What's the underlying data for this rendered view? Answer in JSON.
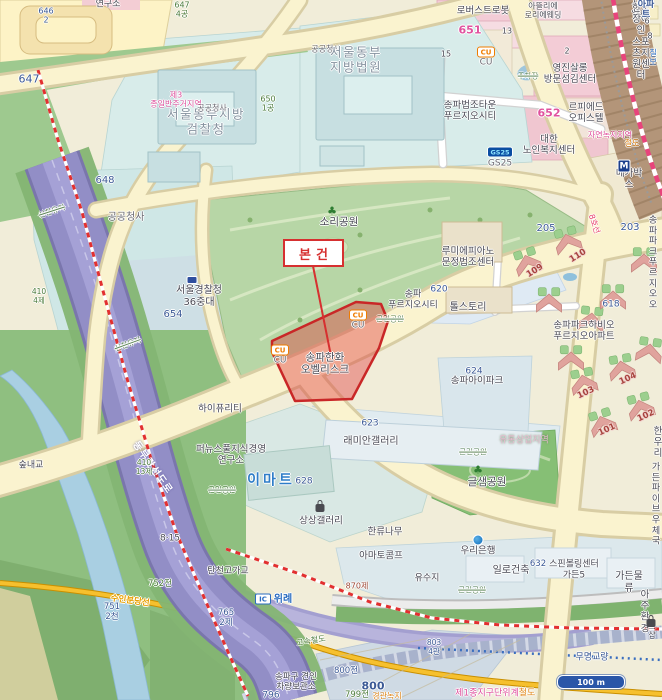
{
  "map": {
    "subject_marker": "본건",
    "scale_bar": "100 m",
    "badges": {
      "cu": "CU",
      "gs25": "GS25",
      "metro": "M",
      "ic": "IC"
    },
    "labels": [
      {
        "t": "646\n2"
      },
      {
        "t": "연구소"
      },
      {
        "t": "647\n4공"
      },
      {
        "t": "647"
      },
      {
        "t": "제3\n종일반주거지역"
      },
      {
        "t": "서울동부지방\n검찰청"
      },
      {
        "t": "공공청사"
      },
      {
        "t": "공공청사"
      },
      {
        "t": "서울동부\n지방법원"
      },
      {
        "t": "650\n1공"
      },
      {
        "t": "648"
      },
      {
        "t": "공공청사"
      },
      {
        "t": "654"
      },
      {
        "t": "서울경찰청\n36중대"
      },
      {
        "t": "지디엠씨"
      },
      {
        "t": "로버스트로봇"
      },
      {
        "t": "아뜰리에\n로리에웨딩"
      },
      {
        "t": "651"
      },
      {
        "t": "13"
      },
      {
        "t": "2"
      },
      {
        "t": "15"
      },
      {
        "t": "한국장애인\n스포츠지원센터"
      },
      {
        "t": "CU"
      },
      {
        "t": "영진살롱\n방문섬김센터"
      },
      {
        "t": "주차장"
      },
      {
        "t": "송파법조타운\n푸르지오시티"
      },
      {
        "t": "652"
      },
      {
        "t": "르피에드\n오피스텔"
      },
      {
        "t": "대한\n노인복지센터"
      },
      {
        "t": "GS25"
      },
      {
        "t": "자연녹지지역"
      },
      {
        "t": "철도"
      },
      {
        "t": "메가박스"
      },
      {
        "t": "657 아파트"
      },
      {
        "t": "칠보"
      },
      {
        "t": "6"
      },
      {
        "t": "8"
      },
      {
        "t": "8호선"
      },
      {
        "t": "205"
      },
      {
        "t": "203"
      },
      {
        "t": "루미에피아노\n문정법조센터"
      },
      {
        "t": "톨스토리"
      },
      {
        "t": "620"
      },
      {
        "t": "송파\n푸르지오시티"
      },
      {
        "t": "근린공원"
      },
      {
        "t": "109"
      },
      {
        "t": "110"
      },
      {
        "t": "618"
      },
      {
        "t": "송파파크하비오\n푸르지오아파트"
      },
      {
        "t": "송파파크\n푸르지오오"
      },
      {
        "t": "101"
      },
      {
        "t": "102"
      },
      {
        "t": "103"
      },
      {
        "t": "104"
      },
      {
        "t": "624"
      },
      {
        "t": "송파아이파크"
      },
      {
        "t": "유통상업지역"
      },
      {
        "t": "근린공원"
      },
      {
        "t": "글샘공원"
      },
      {
        "t": "한우리"
      },
      {
        "t": "가든파이브\n우체국"
      },
      {
        "t": "송파한화\n오벨리스크"
      },
      {
        "t": "CU"
      },
      {
        "t": "CU"
      },
      {
        "t": "숲내교"
      },
      {
        "t": "동부간선도로"
      },
      {
        "t": "신천유지"
      },
      {
        "t": "신천유지"
      },
      {
        "t": "410\n4제"
      },
      {
        "t": "410\n13제"
      },
      {
        "t": "하이퓨리티"
      },
      {
        "t": "퍼뉴스풀지식경영\n연구소"
      },
      {
        "t": "이마트"
      },
      {
        "t": "628"
      },
      {
        "t": "623"
      },
      {
        "t": "래미안갤러리"
      },
      {
        "t": "상상갤러리"
      },
      {
        "t": "한류나무"
      },
      {
        "t": "아마토콤프"
      },
      {
        "t": "우리은행"
      },
      {
        "t": "유수지"
      },
      {
        "t": "일로건축"
      },
      {
        "t": "632"
      },
      {
        "t": "스핀볼링센터\n가든5"
      },
      {
        "t": "가든물류"
      },
      {
        "t": "아주환경"
      },
      {
        "t": "752전"
      },
      {
        "t": "8·15"
      },
      {
        "t": "751\n2천"
      },
      {
        "t": "765\n2제"
      },
      {
        "t": "탄천고가교"
      },
      {
        "t": "수인분당선"
      },
      {
        "t": "위례"
      },
      {
        "t": "고속철도"
      },
      {
        "t": "870제"
      },
      {
        "t": "800전"
      },
      {
        "t": "800"
      },
      {
        "t": "799전"
      },
      {
        "t": "경관녹지"
      },
      {
        "t": "796"
      },
      {
        "t": "송파구 견인\n차량보관소"
      },
      {
        "t": "무명교량"
      },
      {
        "t": "제1종지구단위계"
      },
      {
        "t": "철도"
      },
      {
        "t": "803\n4관"
      },
      {
        "t": "근린공원"
      },
      {
        "t": "근린공원"
      },
      {
        "t": "르샵"
      },
      {
        "t": "소리공원"
      }
    ]
  }
}
